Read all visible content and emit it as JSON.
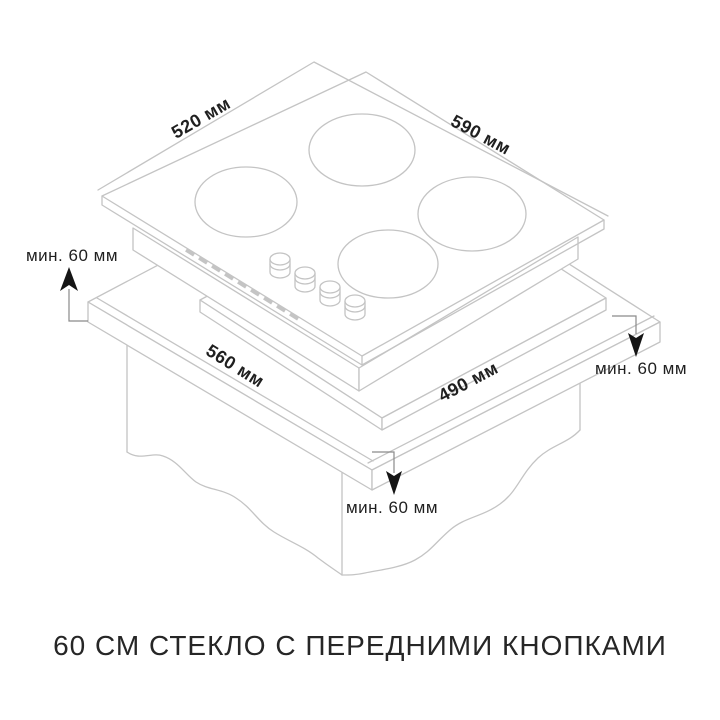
{
  "caption": "60 СМ СТЕКЛО С ПЕРЕДНИМИ КНОПКАМИ",
  "labels": {
    "hob_top_left": "520 мм",
    "hob_top_right": "590 мм",
    "cutout_front_left": "560 мм",
    "cutout_front_right": "490 мм"
  },
  "clearances": {
    "left": "мин. 60 мм",
    "right": "мин. 60 мм",
    "front": "мин. 60 мм"
  },
  "colors": {
    "background": "#ffffff",
    "drawing_line": "#c4c4c4",
    "annotation_line": "#8a8a8a",
    "text": "#1f1f1f"
  }
}
